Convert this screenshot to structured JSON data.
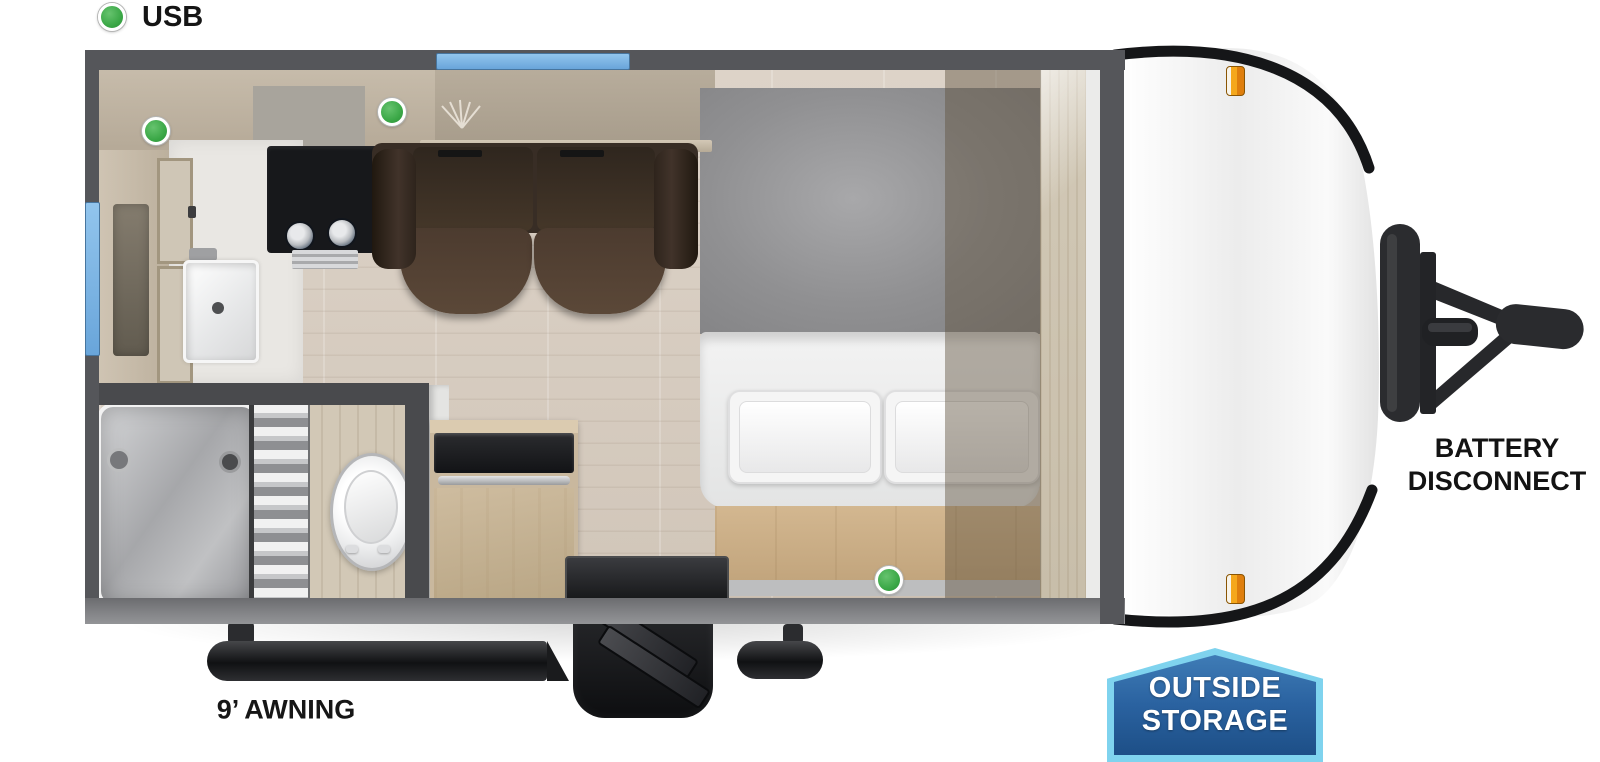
{
  "legend": {
    "usb": "USB"
  },
  "colors": {
    "usb_green": "#3aa746",
    "window_blue": "#7db8e8",
    "wall_gray": "#55565a",
    "badge_border_blue": "#7fd3ee",
    "badge_fill_blue": "#27619f",
    "marker_orange": "#f5a81c"
  },
  "floorplan": {
    "ohc_left": "OHC",
    "ohc_sofa": "OHC",
    "sofa": "SOFA",
    "queen_bed": "QUEEN BED",
    "shelf": "SHELF",
    "tub_shower": {
      "line1": "TUB /",
      "line2": "SHOWER"
    },
    "refer": "REFER",
    "micro": "MICRO"
  },
  "exterior": {
    "awning": "9’ AWNING",
    "battery_disconnect": {
      "line1": "BATTERY",
      "line2": "DISCONNECT"
    },
    "outside_storage": {
      "line1": "OUTSIDE",
      "line2": "STORAGE"
    }
  }
}
